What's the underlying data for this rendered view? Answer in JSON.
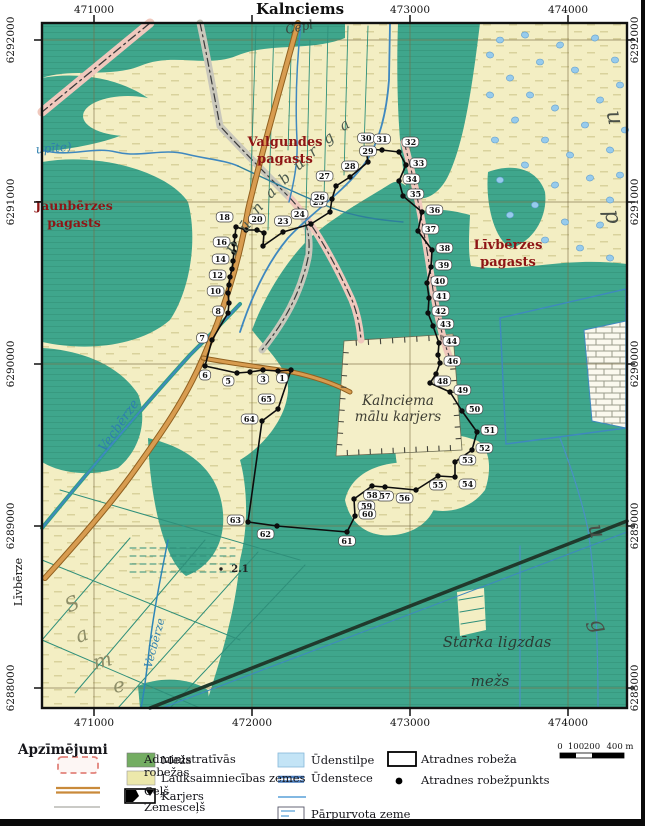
{
  "map_view": {
    "town_label": "Kalnciems",
    "axis": {
      "top": [
        {
          "t": "471000",
          "x": 94
        },
        {
          "t": "473000",
          "x": 410
        },
        {
          "t": "474000",
          "x": 568
        }
      ],
      "bottom": [
        {
          "t": "471000",
          "x": 94
        },
        {
          "t": "472000",
          "x": 252
        },
        {
          "t": "473000",
          "x": 410
        },
        {
          "t": "474000",
          "x": 568
        }
      ],
      "left": [
        {
          "t": "6292000",
          "y": 40
        },
        {
          "t": "6291000",
          "y": 202
        },
        {
          "t": "6290000",
          "y": 364
        },
        {
          "t": "6289000",
          "y": 526
        },
        {
          "t": "6288000",
          "y": 688
        }
      ],
      "right": [
        {
          "t": "6292000",
          "y": 40
        },
        {
          "t": "6291000",
          "y": 202
        },
        {
          "t": "6290000",
          "y": 364
        },
        {
          "t": "6289000",
          "y": 526
        },
        {
          "t": "6288000",
          "y": 688
        }
      ]
    },
    "parish_labels": [
      {
        "name": "parish-valgundes",
        "lines": [
          "Valgundes",
          "pagasts"
        ],
        "x": 285,
        "y": 146,
        "size": 13
      },
      {
        "name": "parish-jaunberzes",
        "lines": [
          "Jaunbērzes",
          "pagasts"
        ],
        "x": 74,
        "y": 210,
        "size": 12.5
      },
      {
        "name": "parish-livberzes",
        "lines": [
          "Līvbērzes",
          "pagasts"
        ],
        "x": 508,
        "y": 249,
        "size": 13
      }
    ],
    "site_labels": [
      {
        "name": "quarry-label",
        "cls": "quarrytxt",
        "lines": [
          "Kalnciema",
          "mālu karjers"
        ],
        "x": 398,
        "y": 405,
        "lh": 16
      },
      {
        "name": "forest-label",
        "cls": "foresttxt",
        "lines": [
          "Stārka ligzdas"
        ],
        "x": 497,
        "y": 647,
        "lh": 16
      },
      {
        "name": "forest-label2",
        "cls": "foresttxt",
        "lines": [
          "mežs"
        ],
        "x": 490,
        "y": 686,
        "lh": 16
      }
    ],
    "water_labels": [
      {
        "t": "Vecbērze",
        "x": 122,
        "y": 428,
        "r": -55,
        "s": 13,
        "cls": "water"
      },
      {
        "t": "Vecbērze",
        "x": 158,
        "y": 644,
        "r": -75,
        "s": 11,
        "cls": "water"
      },
      {
        "t": "upīte)",
        "x": 54,
        "y": 152,
        "r": -5,
        "s": 12,
        "cls": "water"
      },
      {
        "t": "Cepl",
        "x": 300,
        "y": 31,
        "r": -12,
        "s": 12,
        "cls": "waterdark"
      }
    ],
    "stream_name": "Dūnaburga",
    "stream_name_letters": [
      {
        "ch": "D",
        "x": 238,
        "y": 250,
        "r": -65
      },
      {
        "ch": "ū",
        "x": 249,
        "y": 229,
        "r": -55
      },
      {
        "ch": "n",
        "x": 261,
        "y": 211,
        "r": -50
      },
      {
        "ch": "a",
        "x": 274,
        "y": 196,
        "r": -45
      },
      {
        "ch": "b",
        "x": 288,
        "y": 182,
        "r": -43
      },
      {
        "ch": "u",
        "x": 302,
        "y": 168,
        "r": -40
      },
      {
        "ch": "r",
        "x": 316,
        "y": 155,
        "r": -38
      },
      {
        "ch": "g",
        "x": 331,
        "y": 142,
        "r": -35
      },
      {
        "ch": "a",
        "x": 347,
        "y": 129,
        "r": -32
      }
    ],
    "area_letters": [
      {
        "ch": "S",
        "x": 75,
        "y": 610,
        "r": -25,
        "cls": "arealetter1"
      },
      {
        "ch": "a",
        "x": 84,
        "y": 641,
        "r": -20,
        "cls": "arealetter1"
      },
      {
        "ch": "m",
        "x": 104,
        "y": 667,
        "r": -15,
        "cls": "arealetter1"
      },
      {
        "ch": "e",
        "x": 120,
        "y": 692,
        "r": -10,
        "cls": "arealetter1"
      },
      {
        "ch": "u",
        "x": 608,
        "y": 119,
        "r": 78,
        "cls": "arealetter2"
      },
      {
        "ch": "p",
        "x": 606,
        "y": 218,
        "r": 78,
        "cls": "arealetter2"
      },
      {
        "ch": "u",
        "x": 590,
        "y": 533,
        "r": 75,
        "cls": "arealetter2"
      },
      {
        "ch": "g",
        "x": 592,
        "y": 628,
        "r": 70,
        "cls": "arealetter2"
      }
    ],
    "margin_label": {
      "t": "Līvbērze",
      "x": 22,
      "y": 582
    },
    "spot_height": {
      "t": "2.1",
      "x": 240,
      "y": 572
    },
    "boundary_points": [
      {
        "n": "1",
        "x": 291,
        "y": 370,
        "s": "bl"
      },
      {
        "x": 278,
        "y": 371
      },
      {
        "n": "3",
        "x": 263,
        "y": 370,
        "s": "b"
      },
      {
        "x": 250,
        "y": 372
      },
      {
        "n": "5",
        "x": 237,
        "y": 373,
        "s": "bl"
      },
      {
        "n": "6",
        "x": 205,
        "y": 366,
        "s": "b"
      },
      {
        "n": "7",
        "x": 212,
        "y": 340,
        "s": "l"
      },
      {
        "n": "8",
        "x": 228,
        "y": 313,
        "s": "l"
      },
      {
        "x": 229,
        "y": 303
      },
      {
        "n": "10",
        "x": 228,
        "y": 293,
        "s": "l"
      },
      {
        "x": 229,
        "y": 285
      },
      {
        "n": "12",
        "x": 230,
        "y": 277,
        "s": "l"
      },
      {
        "x": 232,
        "y": 269
      },
      {
        "n": "14",
        "x": 233,
        "y": 261,
        "s": "l"
      },
      {
        "x": 234,
        "y": 252
      },
      {
        "n": "16",
        "x": 234,
        "y": 244,
        "s": "l"
      },
      {
        "x": 235,
        "y": 236
      },
      {
        "n": "18",
        "x": 236,
        "y": 227,
        "s": "tl"
      },
      {
        "x": 246,
        "y": 230
      },
      {
        "n": "20",
        "x": 257,
        "y": 230,
        "s": "t"
      },
      {
        "x": 264,
        "y": 233
      },
      {
        "x": 263,
        "y": 246
      },
      {
        "n": "23",
        "x": 283,
        "y": 232,
        "s": "t"
      },
      {
        "n": "24",
        "x": 311,
        "y": 224,
        "s": "tl"
      },
      {
        "n": "25",
        "x": 330,
        "y": 212,
        "s": "tl"
      },
      {
        "n": "26",
        "x": 332,
        "y": 199,
        "s": "l"
      },
      {
        "n": "27",
        "x": 336,
        "y": 186,
        "s": "tl"
      },
      {
        "n": "28",
        "x": 350,
        "y": 177,
        "s": "t"
      },
      {
        "n": "29",
        "x": 368,
        "y": 162,
        "s": "t"
      },
      {
        "n": "30",
        "x": 366,
        "y": 149,
        "s": "t"
      },
      {
        "n": "31",
        "x": 382,
        "y": 150,
        "s": "t"
      },
      {
        "n": "32",
        "x": 399,
        "y": 152,
        "s": "tr"
      },
      {
        "n": "33",
        "x": 406,
        "y": 165,
        "s": "r"
      },
      {
        "n": "34",
        "x": 399,
        "y": 181,
        "s": "r"
      },
      {
        "n": "35",
        "x": 403,
        "y": 196,
        "s": "r"
      },
      {
        "n": "36",
        "x": 422,
        "y": 212,
        "s": "r"
      },
      {
        "n": "37",
        "x": 418,
        "y": 231,
        "s": "r"
      },
      {
        "n": "38",
        "x": 432,
        "y": 250,
        "s": "r"
      },
      {
        "n": "39",
        "x": 431,
        "y": 267,
        "s": "r"
      },
      {
        "n": "40",
        "x": 427,
        "y": 283,
        "s": "r"
      },
      {
        "n": "41",
        "x": 429,
        "y": 298,
        "s": "r"
      },
      {
        "n": "42",
        "x": 428,
        "y": 313,
        "s": "r"
      },
      {
        "n": "43",
        "x": 433,
        "y": 326,
        "s": "r"
      },
      {
        "n": "44",
        "x": 439,
        "y": 343,
        "s": "r"
      },
      {
        "x": 438,
        "y": 355
      },
      {
        "n": "46",
        "x": 440,
        "y": 363,
        "s": "r"
      },
      {
        "x": 436,
        "y": 374
      },
      {
        "n": "48",
        "x": 430,
        "y": 383,
        "s": "r"
      },
      {
        "n": "49",
        "x": 450,
        "y": 392,
        "s": "r"
      },
      {
        "n": "50",
        "x": 462,
        "y": 411,
        "s": "r"
      },
      {
        "n": "51",
        "x": 477,
        "y": 432,
        "s": "r"
      },
      {
        "n": "52",
        "x": 472,
        "y": 450,
        "s": "r"
      },
      {
        "n": "53",
        "x": 455,
        "y": 462,
        "s": "r"
      },
      {
        "n": "54",
        "x": 455,
        "y": 477,
        "s": "br"
      },
      {
        "n": "55",
        "x": 438,
        "y": 476,
        "s": "b"
      },
      {
        "n": "56",
        "x": 416,
        "y": 490,
        "s": "bl"
      },
      {
        "n": "57",
        "x": 385,
        "y": 487,
        "s": "b"
      },
      {
        "n": "58",
        "x": 372,
        "y": 486,
        "s": "b"
      },
      {
        "n": "59",
        "x": 354,
        "y": 499,
        "s": "br"
      },
      {
        "n": "60",
        "x": 355,
        "y": 516,
        "s": "r"
      },
      {
        "n": "61",
        "x": 347,
        "y": 532,
        "s": "b"
      },
      {
        "n": "62",
        "x": 277,
        "y": 526,
        "s": "bl"
      },
      {
        "n": "63",
        "x": 248,
        "y": 522,
        "s": "l"
      },
      {
        "n": "64",
        "x": 262,
        "y": 421,
        "s": "l"
      },
      {
        "n": "65",
        "x": 278,
        "y": 409,
        "s": "tl"
      }
    ]
  },
  "legend": {
    "title": "Apzīmējumi",
    "col1": [
      {
        "label": "Administratīvās robežas",
        "symbol": "admin-boundary"
      },
      {
        "label": "Ceļš",
        "symbol": "road"
      },
      {
        "label": "Zemesceļš",
        "symbol": "dirt-road"
      }
    ],
    "col2": [
      {
        "label": "Mežs",
        "symbol": "forest",
        "color": "#74ad62"
      },
      {
        "label": "Lauksaimniecības zemes",
        "symbol": "farmland",
        "color": "#ece8ab"
      },
      {
        "label": "Karjers",
        "symbol": "quarry"
      }
    ],
    "col3": [
      {
        "label": "Ūdenstilpe",
        "symbol": "waterbody",
        "color": "#c3e4f6"
      },
      {
        "label": "Ūdenstece",
        "symbol": "watercourse"
      },
      {
        "label": "Pārpurvota zeme",
        "symbol": "marsh"
      }
    ],
    "col4": [
      {
        "label": "Atradnes robeža",
        "symbol": "deposit-boundary"
      },
      {
        "label": "Atradnes robežpunkts",
        "symbol": "deposit-point"
      }
    ]
  },
  "scalebar": {
    "labels": [
      {
        "t": "0",
        "x": 560
      },
      {
        "t": "100",
        "x": 576
      },
      {
        "t": "200",
        "x": 592
      },
      {
        "t": "400 m",
        "x": 620
      }
    ]
  }
}
